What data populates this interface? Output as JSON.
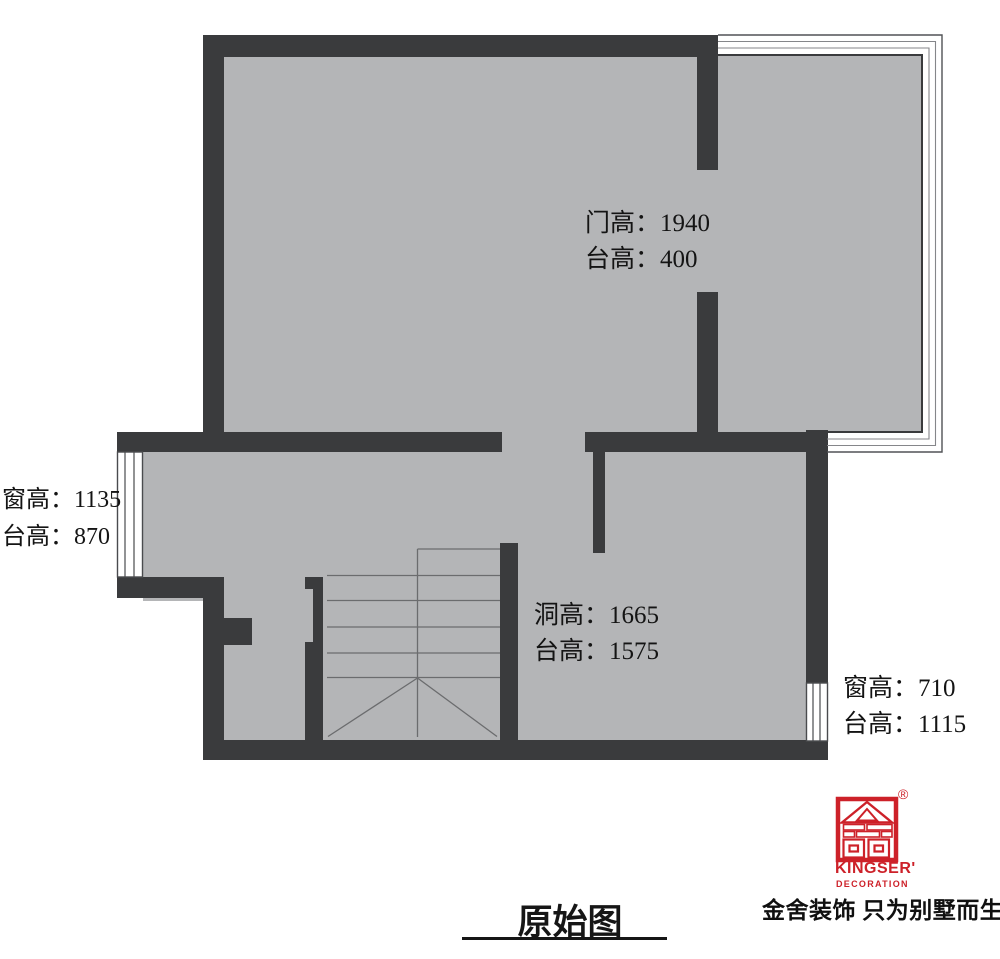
{
  "title": {
    "text": "原始图"
  },
  "plan": {
    "annotations": [
      {
        "id": "door",
        "lines": [
          "门高：1940",
          "台高：400"
        ]
      },
      {
        "id": "left-window",
        "lines": [
          "窗高：1135",
          "台高：870"
        ]
      },
      {
        "id": "opening",
        "lines": [
          "洞高：1665",
          "台高：1575"
        ]
      },
      {
        "id": "right-window",
        "lines": [
          "窗高：710",
          "台高：1115"
        ]
      }
    ]
  },
  "logo": {
    "brand": "KINGSER'",
    "subtitle": "DECORATION",
    "registered": "®",
    "slogan": "金舍装饰 只为别墅而生。"
  },
  "colors": {
    "wall": "#3a3b3d",
    "floor": "#b4b5b7",
    "window_line": "#4a4b4e",
    "stair_line": "#6b6c6e",
    "brand_red": "#cd2129",
    "text": "#141414"
  }
}
